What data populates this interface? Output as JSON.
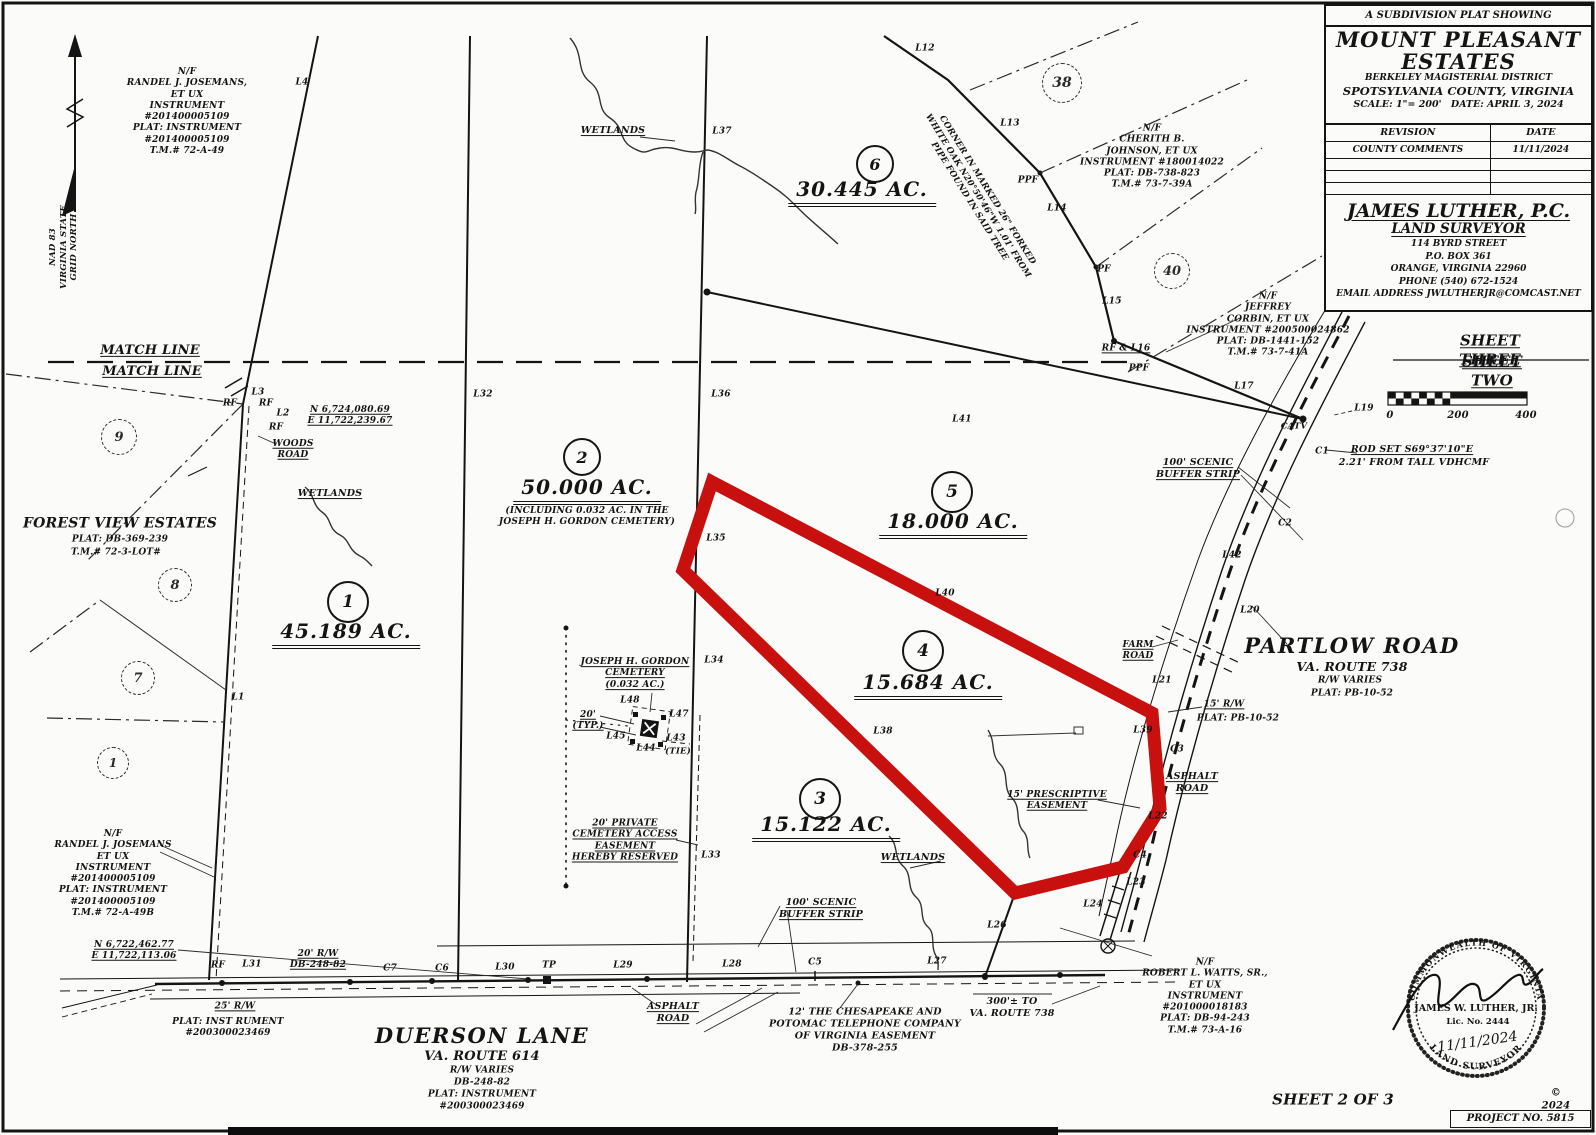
{
  "title_block": {
    "kicker": "A SUBDIVISION PLAT SHOWING",
    "name_line1": "MOUNT PLEASANT",
    "name_line2": "ESTATES",
    "district": "BERKELEY MAGISTERIAL DISTRICT",
    "county": "SPOTSYLVANIA COUNTY, VIRGINIA",
    "scale": "SCALE: 1\"= 200'",
    "date": "DATE: APRIL 3, 2024",
    "revision_header": "REVISION",
    "date_header": "DATE",
    "revisions": [
      {
        "revision": "COUNTY COMMENTS",
        "date": "11/11/2024"
      }
    ]
  },
  "surveyor": {
    "firm": "JAMES LUTHER, P.C.",
    "role": "LAND SURVEYOR",
    "address_lines": [
      "114 BYRD STREET",
      "P.O. BOX 361",
      "ORANGE, VIRGINIA 22960",
      "PHONE (540) 672-1524",
      "EMAIL ADDRESS   JWLUTHERJR@COMCAST.NET"
    ]
  },
  "seal": {
    "commonwealth": "COMMONWEALTH OF VIRGINIA",
    "name": "JAMES W. LUTHER, JR.",
    "lic": "Lic. No. 2444",
    "date": "11/11/2024",
    "role": "LAND SURVEYOR"
  },
  "footer": {
    "sheet": "SHEET 2 OF 3",
    "copyright": "© 2024",
    "project": "PROJECT NO. 5815"
  },
  "colors": {
    "parcel_highlight": "#c8100f",
    "ink": "#141414"
  },
  "parcels": [
    {
      "lot": "1",
      "acreage": "45.189 AC."
    },
    {
      "lot": "2",
      "acreage": "50.000 AC.",
      "note": "(INCLUDING 0.032 AC. IN THE JOSEPH H. GORDON CEMETERY)"
    },
    {
      "lot": "3",
      "acreage": "15.122 AC."
    },
    {
      "lot": "4",
      "acreage": "15.684 AC.",
      "highlighted": true
    },
    {
      "lot": "5",
      "acreage": "18.000 AC."
    },
    {
      "lot": "6",
      "acreage": "30.445 AC."
    }
  ],
  "lot_markers": [
    {
      "n": "1",
      "x": 348,
      "y": 602,
      "r": 19,
      "fs": 17
    },
    {
      "n": "2",
      "x": 582,
      "y": 457,
      "r": 17,
      "fs": 16
    },
    {
      "n": "3",
      "x": 820,
      "y": 799,
      "r": 19,
      "fs": 17
    },
    {
      "n": "4",
      "x": 923,
      "y": 651,
      "r": 19,
      "fs": 17
    },
    {
      "n": "5",
      "x": 952,
      "y": 492,
      "r": 19,
      "fs": 17
    },
    {
      "n": "6",
      "x": 875,
      "y": 164,
      "r": 17,
      "fs": 16
    },
    {
      "n": "38",
      "x": 1062,
      "y": 83,
      "r": 19,
      "fs": 14,
      "d": 1
    },
    {
      "n": "40",
      "x": 1172,
      "y": 271,
      "r": 17,
      "fs": 13,
      "d": 1
    },
    {
      "n": "9",
      "x": 119,
      "y": 437,
      "r": 17,
      "fs": 13,
      "d": 1
    },
    {
      "n": "8",
      "x": 175,
      "y": 585,
      "r": 16,
      "fs": 13,
      "d": 1
    },
    {
      "n": "7",
      "x": 138,
      "y": 678,
      "r": 16,
      "fs": 13,
      "d": 1
    },
    {
      "n": "1",
      "x": 113,
      "y": 763,
      "r": 15,
      "fs": 12,
      "d": 1
    }
  ],
  "labels": [
    {
      "t": "N/F\nRANDEL J. JOSEMANS,\nET UX\nINSTRUMENT\n#201400005109\nPLAT: INSTRUMENT\n#201400005109\nT.M.# 72-A-49",
      "x": 187,
      "y": 112,
      "fs": 9,
      "name": "owner-josemans-north"
    },
    {
      "t": "L4",
      "x": 302,
      "y": 83
    },
    {
      "t": "NAD 83\nVIRGINIA STATE\nGRID NORTH",
      "x": 64,
      "y": 247,
      "fs": 8.5,
      "r": -90,
      "name": "north-datum-note"
    },
    {
      "t": "MATCH LINE",
      "x": 150,
      "y": 351,
      "fs": 13,
      "u": 1,
      "name": "match-line-label"
    },
    {
      "t": "MATCH LINE",
      "x": 152,
      "y": 372,
      "fs": 13,
      "u": 1,
      "name": "match-line-label"
    },
    {
      "t": "L3",
      "x": 258,
      "y": 393
    },
    {
      "t": "RF",
      "x": 230,
      "y": 404
    },
    {
      "t": "RF",
      "x": 266,
      "y": 404
    },
    {
      "t": "L2",
      "x": 283,
      "y": 414
    },
    {
      "t": "RF",
      "x": 276,
      "y": 428
    },
    {
      "t": "N 6,724,080.69\nE 11,722,239.67",
      "x": 350,
      "y": 416,
      "fs": 9,
      "u": 1,
      "name": "coordinate-note-north"
    },
    {
      "t": "WOODS\nROAD",
      "x": 293,
      "y": 450,
      "fs": 9,
      "u": 1,
      "name": "woods-road-label"
    },
    {
      "t": "WETLANDS",
      "x": 330,
      "y": 494,
      "fs": 9.5,
      "u": 1,
      "name": "wetlands-label"
    },
    {
      "t": "FOREST VIEW ESTATES",
      "x": 120,
      "y": 524,
      "fs": 14,
      "name": "forest-view-estates-label"
    },
    {
      "t": "PLAT: DB-369-239",
      "x": 120,
      "y": 540,
      "fs": 9
    },
    {
      "t": "T.M.# 72-3-LOT#",
      "x": 116,
      "y": 553,
      "fs": 9
    },
    {
      "t": "L1",
      "x": 238,
      "y": 698
    },
    {
      "t": "45.189 AC.",
      "x": 346,
      "y": 634,
      "fs": 20,
      "cls": "ac",
      "name": "lot1-acreage"
    },
    {
      "t": "50.000 AC.",
      "x": 587,
      "y": 490,
      "fs": 20,
      "cls": "ac",
      "name": "lot2-acreage"
    },
    {
      "t": "(INCLUDING 0.032 AC. IN THE\nJOSEPH H. GORDON CEMETERY)",
      "x": 587,
      "y": 517,
      "fs": 9,
      "name": "lot2-cemetery-note"
    },
    {
      "t": "30.445 AC.",
      "x": 862,
      "y": 192,
      "fs": 20,
      "cls": "ac",
      "name": "lot6-acreage"
    },
    {
      "t": "18.000 AC.",
      "x": 953,
      "y": 524,
      "fs": 20,
      "cls": "ac",
      "name": "lot5-acreage"
    },
    {
      "t": "15.684 AC.",
      "x": 928,
      "y": 685,
      "fs": 20,
      "cls": "ac",
      "name": "lot4-acreage"
    },
    {
      "t": "15.122 AC.",
      "x": 826,
      "y": 827,
      "fs": 20,
      "cls": "ac",
      "name": "lot3-acreage"
    },
    {
      "t": "N/F\nRANDEL J. JOSEMANS\nET UX\nINSTRUMENT\n#201400005109\nPLAT: INSTRUMENT\n#201400005109\nT.M.# 72-A-49B",
      "x": 113,
      "y": 874,
      "fs": 9,
      "name": "owner-josemans-south"
    },
    {
      "t": "N 6,722,462.77\nE 11,722,113.06",
      "x": 134,
      "y": 951,
      "fs": 9,
      "u": 1,
      "name": "coordinate-note-south"
    },
    {
      "t": "RF",
      "x": 218,
      "y": 966
    },
    {
      "t": "L31",
      "x": 252,
      "y": 965
    },
    {
      "t": "20' R/W\nDB-248-82",
      "x": 318,
      "y": 960,
      "fs": 9,
      "u": 1
    },
    {
      "t": "25' R/W",
      "x": 235,
      "y": 1007,
      "fs": 9,
      "u": 1
    },
    {
      "t": "PLAT: INST RUMENT\n#200300023469",
      "x": 228,
      "y": 1028,
      "fs": 9
    },
    {
      "t": "C7",
      "x": 390,
      "y": 969
    },
    {
      "t": "C6",
      "x": 442,
      "y": 969
    },
    {
      "t": "L30",
      "x": 505,
      "y": 968
    },
    {
      "t": "TP",
      "x": 549,
      "y": 966
    },
    {
      "t": "L29",
      "x": 623,
      "y": 966
    },
    {
      "t": "ASPHALT\nROAD",
      "x": 673,
      "y": 1013,
      "fs": 9.5,
      "u": 1,
      "name": "asphalt-road-label"
    },
    {
      "t": "L28",
      "x": 732,
      "y": 965
    },
    {
      "t": "C5",
      "x": 815,
      "y": 963
    },
    {
      "t": "L27",
      "x": 937,
      "y": 962
    },
    {
      "t": "DUERSON LANE",
      "x": 482,
      "y": 1036,
      "fs": 21,
      "cls": "road",
      "name": "duerson-lane-label"
    },
    {
      "t": "VA. ROUTE 614",
      "x": 482,
      "y": 1057,
      "fs": 13
    },
    {
      "t": "R/W VARIES",
      "x": 482,
      "y": 1071,
      "fs": 9
    },
    {
      "t": "DB-248-82",
      "x": 482,
      "y": 1083,
      "fs": 9
    },
    {
      "t": "PLAT: INSTRUMENT",
      "x": 482,
      "y": 1095,
      "fs": 9
    },
    {
      "t": "#200300023469",
      "x": 482,
      "y": 1107,
      "fs": 9
    },
    {
      "t": "12' THE CHESAPEAKE AND\nPOTOMAC TELEPHONE COMPANY\nOF VIRGINIA EASEMENT\nDB-378-255",
      "x": 865,
      "y": 1030,
      "fs": 9.5,
      "name": "telephone-easement-note"
    },
    {
      "t": "100' SCENIC\nBUFFER STRIP",
      "x": 821,
      "y": 909,
      "fs": 9.5,
      "u": 1,
      "name": "scenic-buffer-label"
    },
    {
      "t": "WETLANDS",
      "x": 913,
      "y": 858,
      "fs": 9.5,
      "u": 1,
      "name": "wetlands-label"
    },
    {
      "t": "L26",
      "x": 997,
      "y": 926
    },
    {
      "t": "300'± TO\nVA. ROUTE 738",
      "x": 1012,
      "y": 1008,
      "fs": 9.5
    },
    {
      "t": "N/F\nROBERT L. WATTS, SR.,\nET UX\nINSTRUMENT\n#201000018183\nPLAT: DB-94-243\nT.M.# 73-A-16",
      "x": 1205,
      "y": 997,
      "fs": 9,
      "name": "owner-watts"
    },
    {
      "t": "L24",
      "x": 1093,
      "y": 905
    },
    {
      "t": "L23",
      "x": 1136,
      "y": 883
    },
    {
      "t": "C4",
      "x": 1140,
      "y": 856
    },
    {
      "t": "L22",
      "x": 1158,
      "y": 817
    },
    {
      "t": "15' PRESCRIPTIVE\nEASEMENT",
      "x": 1057,
      "y": 801,
      "fs": 9,
      "u": 1,
      "name": "prescriptive-easement-note"
    },
    {
      "t": "ASPHALT\nROAD",
      "x": 1192,
      "y": 783,
      "fs": 9.5,
      "u": 1,
      "name": "asphalt-road-label"
    },
    {
      "t": "C3",
      "x": 1177,
      "y": 750
    },
    {
      "t": "L39",
      "x": 1143,
      "y": 731
    },
    {
      "t": "15' R/W",
      "x": 1224,
      "y": 705,
      "fs": 9,
      "u": 1
    },
    {
      "t": "PLAT: PB-10-52",
      "x": 1238,
      "y": 719,
      "fs": 9
    },
    {
      "t": "L21",
      "x": 1162,
      "y": 681
    },
    {
      "t": "FARM\nROAD",
      "x": 1138,
      "y": 651,
      "fs": 9,
      "u": 1,
      "name": "farm-road-label"
    },
    {
      "t": "PARTLOW ROAD",
      "x": 1352,
      "y": 646,
      "fs": 21,
      "cls": "road",
      "name": "partlow-road-label"
    },
    {
      "t": "VA. ROUTE 738",
      "x": 1352,
      "y": 667,
      "fs": 12.5
    },
    {
      "t": "R/W VARIES",
      "x": 1350,
      "y": 681,
      "fs": 9
    },
    {
      "t": "PLAT: PB-10-52",
      "x": 1352,
      "y": 694,
      "fs": 9
    },
    {
      "t": "L20",
      "x": 1250,
      "y": 611
    },
    {
      "t": "L42",
      "x": 1232,
      "y": 556
    },
    {
      "t": "C2",
      "x": 1285,
      "y": 524
    },
    {
      "t": "100' SCENIC\nBUFFER STRIP",
      "x": 1198,
      "y": 469,
      "fs": 9.5,
      "u": 1,
      "name": "scenic-buffer-label"
    },
    {
      "t": "ROD SET S69°37'10\"E",
      "x": 1412,
      "y": 450,
      "fs": 9.5,
      "u": 1,
      "name": "rod-set-note"
    },
    {
      "t": "2.21' FROM TALL VDHCMF",
      "x": 1414,
      "y": 463,
      "fs": 9.5
    },
    {
      "t": "C1",
      "x": 1322,
      "y": 452
    },
    {
      "t": "CATV",
      "x": 1294,
      "y": 427,
      "fs": 8.5
    },
    {
      "t": "L19",
      "x": 1364,
      "y": 409
    },
    {
      "t": "0",
      "x": 1390,
      "y": 416,
      "fs": 10,
      "name": "scale-bar-0"
    },
    {
      "t": "200",
      "x": 1458,
      "y": 416,
      "fs": 10,
      "name": "scale-bar-200"
    },
    {
      "t": "400",
      "x": 1526,
      "y": 416,
      "fs": 10,
      "name": "scale-bar-400"
    },
    {
      "t": "SHEET THREE",
      "x": 1490,
      "y": 350,
      "fs": 15,
      "u": 1,
      "name": "sheet-three-label"
    },
    {
      "t": "SHEET TWO",
      "x": 1492,
      "y": 371,
      "fs": 15,
      "u": 1,
      "name": "sheet-two-label"
    },
    {
      "t": "L17",
      "x": 1244,
      "y": 387
    },
    {
      "t": "RF & L16",
      "x": 1126,
      "y": 349,
      "fs": 9,
      "u": 1
    },
    {
      "t": "PPF",
      "x": 1139,
      "y": 369
    },
    {
      "t": "L15",
      "x": 1112,
      "y": 302
    },
    {
      "t": "N/F\nJEFFREY\nCORBIN, ET UX\nINSTRUMENT #200500024862\nPLAT: DB-1441-152\nT.M.# 73-7-41A",
      "x": 1268,
      "y": 325,
      "fs": 9,
      "name": "owner-corbin"
    },
    {
      "t": "N/F\nCHERITH B.\nJOHNSON, ET UX\nINSTRUMENT #180014022\nPLAT: DB-738-823\nT.M.# 73-7-39A",
      "x": 1152,
      "y": 157,
      "fs": 9,
      "name": "owner-johnson"
    },
    {
      "t": "PF",
      "x": 1104,
      "y": 270
    },
    {
      "t": "L14",
      "x": 1057,
      "y": 209
    },
    {
      "t": "PPF",
      "x": 1028,
      "y": 181
    },
    {
      "t": "L13",
      "x": 1010,
      "y": 124
    },
    {
      "t": "L12",
      "x": 925,
      "y": 49
    },
    {
      "t": "CORNER IN MARKED 26\" FORKED\nWHITE OAK N20°50'46\"W 1.01' FROM\nPIPE FOUND IN SAID TREE",
      "x": 978,
      "y": 196,
      "fs": 8.5,
      "r": 58,
      "name": "corner-tree-note"
    },
    {
      "t": "WETLANDS",
      "x": 613,
      "y": 131,
      "fs": 9.5,
      "u": 1,
      "name": "wetlands-label"
    },
    {
      "t": "L37",
      "x": 722,
      "y": 132
    },
    {
      "t": "L32",
      "x": 483,
      "y": 395
    },
    {
      "t": "L36",
      "x": 721,
      "y": 395
    },
    {
      "t": "L41",
      "x": 962,
      "y": 420
    },
    {
      "t": "L35",
      "x": 716,
      "y": 539
    },
    {
      "t": "L40",
      "x": 945,
      "y": 594
    },
    {
      "t": "JOSEPH H. GORDON\nCEMETERY\n(0.032 AC.)",
      "x": 635,
      "y": 674,
      "fs": 9,
      "u": 1,
      "name": "cemetery-label"
    },
    {
      "t": "L34",
      "x": 714,
      "y": 661
    },
    {
      "t": "L48",
      "x": 630,
      "y": 701
    },
    {
      "t": "20'\n(TYP.)",
      "x": 588,
      "y": 721,
      "fs": 9,
      "u": 1
    },
    {
      "t": "L47",
      "x": 679,
      "y": 715
    },
    {
      "t": "L45",
      "x": 616,
      "y": 737
    },
    {
      "t": "L44",
      "x": 646,
      "y": 749
    },
    {
      "t": "L43",
      "x": 676,
      "y": 739
    },
    {
      "t": "(TIE)",
      "x": 678,
      "y": 752,
      "fs": 8.5
    },
    {
      "t": "L38",
      "x": 883,
      "y": 732
    },
    {
      "t": "L33",
      "x": 711,
      "y": 856
    },
    {
      "t": "20' PRIVATE\nCEMETERY ACCESS\nEASEMENT\nHEREBY RESERVED",
      "x": 625,
      "y": 841,
      "fs": 9,
      "u": 1,
      "name": "cemetery-access-easement-note"
    },
    {
      "t": "SHEET 2 OF 3",
      "x": 1333,
      "y": 1100,
      "fs": 15,
      "name": "sheet-number-label"
    },
    {
      "t": "© 2024",
      "x": 1556,
      "y": 1100,
      "fs": 10,
      "name": "copyright-label"
    }
  ]
}
